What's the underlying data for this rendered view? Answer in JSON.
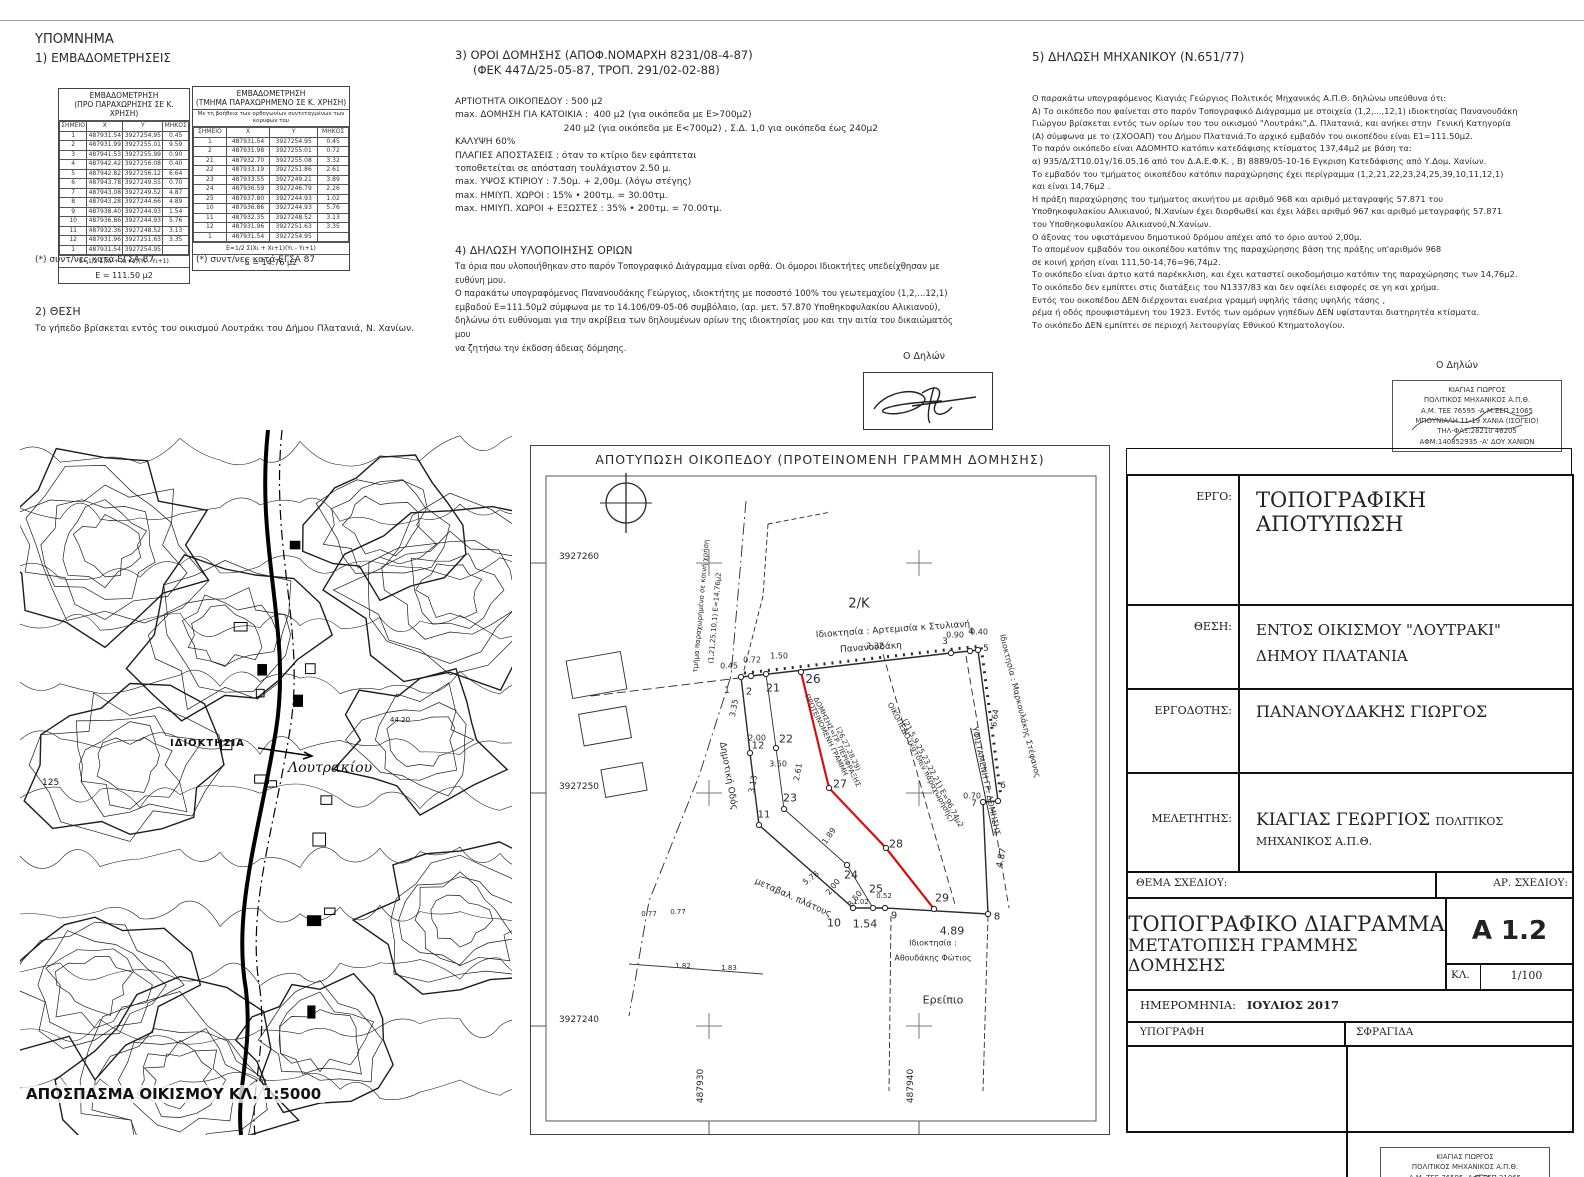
{
  "colors": {
    "line": "#2a2a2a",
    "red_line": "#d40f0f",
    "border": "#111111"
  },
  "legend": {
    "title": "ΥΠΟΜΝΗΜΑ",
    "section1_title": "1) ΕΜΒΑΔΟΜΕΤΡΗΣΕΙΣ",
    "table1": {
      "title_l1": "ΕΜΒΑΔΟΜΕΤΡΗΣΗ",
      "title_l2": "(ΠΡΟ ΠΑΡΑΧΩΡΗΣΗΣ ΣΕ Κ. ΧΡΗΣΗ)",
      "headers": [
        "ΣΗΜΕΙΟ",
        "Χ",
        "Υ",
        "ΜΗΚΟΣ"
      ],
      "rows": [
        [
          "1",
          "487931.54",
          "3927254.95",
          "0.45"
        ],
        [
          "2",
          "487931.99",
          "3927255.01",
          "9.59"
        ],
        [
          "3",
          "487941.53",
          "3927255.99",
          "0.90"
        ],
        [
          "4",
          "487942.42",
          "3927256.08",
          "0.40"
        ],
        [
          "5",
          "487942.82",
          "3927256.12",
          "6.64"
        ],
        [
          "6",
          "487943.78",
          "3927249.55",
          "0.70"
        ],
        [
          "7",
          "487943.08",
          "3927249.52",
          "4.87"
        ],
        [
          "8",
          "487943.28",
          "3927244.66",
          "4.89"
        ],
        [
          "9",
          "487938.40",
          "3927244.93",
          "1.54"
        ],
        [
          "10",
          "487936.86",
          "3927244.93",
          "5.76"
        ],
        [
          "11",
          "487932.36",
          "3927248.52",
          "3.13"
        ],
        [
          "12",
          "487931.96",
          "3927251.63",
          "3.35"
        ],
        [
          "1",
          "487931.54",
          "3927254.95",
          ""
        ]
      ],
      "formula": "Ε=1/2 Σ(Χι + Χι+1)(Υι - Υι+1)",
      "area": "Ε = 111.50 μ2",
      "footnote": "(*) συντ/νες κατά ΕΓΣΑ 87"
    },
    "table2": {
      "title_l1": "ΕΜΒΑΔΟΜΕΤΡΗΣΗ",
      "title_l2": "(ΤΜΗΜΑ ΠΑΡΑΧΩΡΗΜΕΝΟ ΣΕ Κ. ΧΡΗΣΗ)",
      "subtitle": "Με τη βοήθεια των ορθογωνίων συντεταγμένων των κορυφών του",
      "headers": [
        "ΣΗΜΕΙΟ",
        "Χ",
        "Υ",
        "ΜΗΚΟΣ"
      ],
      "rows": [
        [
          "1",
          "487931.54",
          "3927254.95",
          "0.45"
        ],
        [
          "2",
          "487931.98",
          "3927255.01",
          "0.72"
        ],
        [
          "21",
          "487932.70",
          "3927255.08",
          "3.32"
        ],
        [
          "22",
          "487933.19",
          "3927251.86",
          "2.61"
        ],
        [
          "23",
          "487933.55",
          "3927249.21",
          "3.89"
        ],
        [
          "24",
          "487936.59",
          "3927246.79",
          "2.26"
        ],
        [
          "25",
          "487937.80",
          "3927244.93",
          "1.02"
        ],
        [
          "10",
          "487936.86",
          "3927244.93",
          "5.76"
        ],
        [
          "11",
          "487932.35",
          "3927248.52",
          "3.13"
        ],
        [
          "12",
          "487931.96",
          "3927251.63",
          "3.35"
        ],
        [
          "1",
          "487931.54",
          "3927254.95",
          ""
        ]
      ],
      "formula": "Ε=1/2 Σ(Χι + Χι+1)(Υι - Υι+1)",
      "area": "Ε = 14.76 μ2",
      "footnote": "(*) συντ/νες κατά ΕΓΣΑ 87"
    },
    "section2_title": "2) ΘΕΣΗ",
    "section2_text": "Το γήπεδο βρίσκεται εντός του οικισμού Λουτράκι του Δήμου Πλατανιά, Ν. Χανίων."
  },
  "terms": {
    "title_l1": "3) ΟΡΟΙ ΔΟΜΗΣΗΣ (ΑΠΟΦ.ΝΟΜΑΡΧΗ 8231/08-4-87)",
    "title_l2": "(ΦΕΚ 447Δ/25-05-87, ΤΡΟΠ. 291/02-02-88)",
    "lines": [
      "ΑΡΤΙΟΤΗΤΑ ΟΙΚΟΠΕΔΟΥ : 500 μ2",
      "max. ΔΟΜΗΣΗ ΓΙΑ ΚΑΤΟΙΚΙΑ :  400 μ2 (για οικόπεδα με Ε>700μ2)",
      "                                      240 μ2 (για οικόπεδα με Ε<700μ2) , Σ.Δ. 1,0 για οικόπεδα έως 240μ2",
      "ΚΑΛΥΨΗ 60%",
      "ΠΛΑΓΙΕΣ ΑΠΟΣΤΑΣΕΙΣ : όταν το κτίριο δεν εφάπτεται",
      "τοποθετείται σε απόσταση τουλάχιστον 2.50 μ.",
      "max. ΥΨΟΣ ΚΤΙΡΙΟΥ : 7.50μ. + 2,00μ. (λόγω στέγης)",
      "max. ΗΜΙΥΠ. ΧΩΡΟΙ : 15% • 200τμ. = 30.00τμ.",
      "max. ΗΜΙΥΠ. ΧΩΡΟΙ + ΕΞΩΣΤΕΣ : 35% • 200τμ. = 70.00τμ."
    ]
  },
  "declaration_limits": {
    "title": "4) ΔΗΛΩΣΗ ΥΛΟΠΟΙΗΣΗΣ ΟΡΙΩΝ",
    "lines": [
      "Τα όρια που υλοποιήθηκαν στο παρόν Τοπογραφικό Διάγραμμα είναι ορθά. Οι όμοροι Ιδιοκτήτες υπεδείχθησαν με ευθύνη μου.",
      "Ο παρακάτω υπογραφόμενος Πανανουδάκης Γεώργιος, ιδιοκτήτης με ποσοστό 100% του γεωτεμαχίου (1,2,...12,1)",
      "εμβαδού Ε=111.50μ2 σύμφωνα με το 14.106/09-05-06 συμβόλαιο, (αρ. μετ. 57.870 Υποθηκοφυλακίου Αλικιανού),",
      "δηλώνω ότι ευθύνομαι για την ακρίβεια των δηλουμένων ορίων της ιδιοκτησίας μου και την αιτία του δικαιώματός μου",
      "να ζητήσω την έκδοση άδειας δόμησης."
    ]
  },
  "declaration_engineer": {
    "title": "5) ΔΗΛΩΣΗ ΜΗΧΑΝΙΚΟΥ (Ν.651/77)",
    "lines": [
      "Ο παρακάτω υπογραφόμενος Κιαγιάς Γεώργιος Πολιτικός Μηχανικός Α.Π.Θ. δηλώνω υπεύθυνα ότι:",
      "Α) Το οικόπεδο που φαίνεται στο παρόν Τοπογραφικό Διάγραμμα με στοιχεία (1,2,...,12,1) ιδιοκτησίας Πανανουδάκη",
      "Γιώργου βρίσκεται εντός των ορίων του του οικισμού \"Λουτράκι\",Δ. Πλατανιά, και ανήκει στην  Γενική Κατηγορία",
      "(Α) σύμφωνα με το (ΣΧΟΟΑΠ) του Δήμου Πλατανιά.Το αρχικό εμβαδόν του οικοπέδου είναι Ε1=111.50μ2.",
      "Το παρόν οικόπεδο είναι ΑΔΟΜΗΤΟ κατόπιν κατεδάφισης κτίσματος 137,44μ2 με βάση τα:",
      "α) 935/Δ/ΣΤ10.01γ/16.05.16 από τον Δ.Α.Ε.Φ.Κ. , Β) 8889/05-10-16 Εγκριση Κατεδάφισης από Υ.Δομ. Χανίων.",
      "Το εμβαδόν του τμήματος οικοπέδου κατόπιν παραχώρησης έχει περίγραμμα (1,2,21,22,23,24,25,39,10,11,12,1)",
      "και είναι 14,76μ2 .",
      "Η πράξη παραχώρησης του τμήματος ακινήτου με αριθμό 968 και αριθμό μεταγραφής 57.871 του",
      "Υποθηκοφυλακίου Αλικιανού, Ν.Χανίων έχει διορθωθεί και έχει λάβει αριθμό 967 και αριθμό μεταγραφής 57.871",
      "του Υποθηκοφυλακίου Αλικιανού,Ν.Χανίων.",
      "Ο άξονας του υφιστάμενου δημοτικού δρόμου απέχει από το όριο αυτού 2,00μ.",
      "Το απομένον εμβαδόν του οικοπέδου κατόπιν της παραχώρησης βάση της πράξης υπ'αριθμόν 968",
      "σε κοινή χρήση είναι 111,50-14,76=96,74μ2.",
      "Το οικόπεδο είναι άρτιο κατά παρέκκλιση, και έχει καταστεί οικοδομήσιμο κατόπιν της παραχώρησης των 14,76μ2.",
      "Το οικόπεδο δεν εμπίπτει στις διατάξεις του Ν1337/83 και δεν οφείλει εισφορές σε γη και χρήμα.",
      "Εντός του οικοπέδου ΔΕΝ διέρχονται εναέρια γραμμή υψηλής τάσης υψηλής τάσης ,",
      "ρέμα ή οδός προυφιστάμενη του 1923. Εντός των ομόρων γηπέδων ΔΕΝ υφίστανται διατηρητέα κτίσματα.",
      "Το οικόπεδο ΔΕΝ εμπίπτει σε περιοχή λειτουργίας Εθνικού Κτηματολογίου."
    ]
  },
  "signer_label": "Ο Δηλών",
  "stamp": {
    "lines": [
      "ΚΙΑΓΙΑΣ ΓΙΩΡΓΟΣ",
      "ΠΟΛΙΤΙΚΟΣ ΜΗΧΑΝΙΚΟΣ Α.Π.Θ.",
      "Α.Μ. ΤΕΕ 76595 -Α.Μ.ΕΕΠ 21065",
      "ΜΠΟΥΝΙΑΛΗ 11-19 ΧΑΝΙΑ (ΙΣΟΓΕΙΟ)",
      "ΤΗΛ-ΦΑΞ:28210 46205",
      "ΑΦΜ:140852935 -Α' ΔΟΥ ΧΑΝΙΩΝ"
    ]
  },
  "map": {
    "caption": "ΑΠΟΣΠΑΣΜΑ ΟΙΚΙΣΜΟΥ ΚΛ. 1:5000",
    "label_property": "ΙΔΙΟΚΤΗΣΙΑ",
    "label_place": "Λουτρακίου",
    "elev1": "44.20",
    "elev2": "125"
  },
  "plan": {
    "title": "ΑΠΟΤΥΠΩΣΗ ΟΙΚΟΠΕΔΟΥ (ΠΡΟΤΕΙΝΟΜΕΝΗ ΓΡΑΜΜΗ ΔΟΜΗΣΗΣ)",
    "geo": {
      "frame": [
        15,
        30,
        550,
        645
      ],
      "outline": [
        [
          210,
          231
        ],
        [
          220,
          230
        ],
        [
          420,
          207
        ],
        [
          439,
          205
        ],
        [
          447,
          204
        ],
        [
          467,
          355
        ],
        [
          452,
          356
        ],
        [
          457,
          468
        ],
        [
          354,
          462
        ],
        [
          322,
          462
        ],
        [
          228,
          379
        ],
        [
          219,
          307
        ],
        [
          210,
          231
        ]
      ],
      "ceded": [
        [
          235,
          228
        ],
        [
          245,
          302
        ],
        [
          253,
          363
        ],
        [
          316,
          419
        ],
        [
          342,
          462
        ]
      ],
      "red": [
        [
          270,
          226
        ],
        [
          298,
          342
        ],
        [
          355,
          402
        ],
        [
          403,
          463
        ]
      ],
      "dashes": [
        {
          "pts": [
            [
              435,
              210
            ],
            [
              478,
              462
            ]
          ],
          "d": "7,4"
        },
        {
          "pts": [
            [
              352,
              208
            ],
            [
              425,
              462
            ]
          ],
          "d": "7,4"
        },
        {
          "pts": [
            [
              215,
              55
            ],
            [
              200,
              230
            ],
            [
              168,
              330
            ],
            [
              118,
              455
            ],
            [
              98,
              570
            ]
          ],
          "d": "12,4,2,4"
        },
        {
          "pts": [
            [
              237,
              78
            ],
            [
              232,
              150
            ],
            [
              212,
              228
            ]
          ],
          "d": "5,3"
        },
        {
          "pts": [
            [
              237,
              78
            ],
            [
              300,
              66
            ]
          ],
          "d": "5,3"
        },
        {
          "pts": [
            [
              360,
              470
            ],
            [
              358,
              645
            ]
          ],
          "d": "6,3"
        },
        {
          "pts": [
            [
              457,
              470
            ],
            [
              452,
              645
            ]
          ],
          "d": "6,3"
        },
        {
          "pts": [
            [
              98,
              518
            ],
            [
              232,
              528
            ]
          ],
          "d": "2,0"
        },
        {
          "pts": [
            [
              60,
              250
            ],
            [
              208,
              232
            ]
          ],
          "d": "9,4"
        }
      ],
      "rects": [
        [
          38,
          210,
          55,
          38
        ],
        [
          50,
          264,
          48,
          32
        ],
        [
          72,
          320,
          42,
          28
        ]
      ],
      "crosses": [
        [
          178,
          117
        ],
        [
          388,
          117
        ],
        [
          178,
          347
        ],
        [
          388,
          347
        ],
        [
          178,
          580
        ],
        [
          388,
          580
        ]
      ],
      "points": [
        [
          210,
          231
        ],
        [
          220,
          230
        ],
        [
          235,
          228
        ],
        [
          270,
          226
        ],
        [
          420,
          207
        ],
        [
          439,
          205
        ],
        [
          447,
          204
        ],
        [
          467,
          355
        ],
        [
          452,
          356
        ],
        [
          457,
          468
        ],
        [
          354,
          462
        ],
        [
          322,
          462
        ],
        [
          228,
          379
        ],
        [
          219,
          307
        ],
        [
          245,
          302
        ],
        [
          253,
          363
        ],
        [
          316,
          419
        ],
        [
          342,
          462
        ],
        [
          298,
          342
        ],
        [
          355,
          402
        ],
        [
          403,
          463
        ]
      ],
      "north": [
        95,
        57
      ],
      "yticks": [
        [
          117,
          "3927260"
        ],
        [
          347,
          "3927250"
        ],
        [
          580,
          "3927240"
        ]
      ],
      "xticks": [
        [
          178,
          "487930"
        ],
        [
          388,
          "487940"
        ]
      ]
    },
    "labels": [
      {
        "t": "1",
        "x": 196,
        "y": 245,
        "s": 9
      },
      {
        "t": "2",
        "x": 218,
        "y": 246,
        "s": 10
      },
      {
        "t": "21",
        "x": 242,
        "y": 242,
        "s": 11
      },
      {
        "t": "26",
        "x": 282,
        "y": 233,
        "s": 12
      },
      {
        "t": "3",
        "x": 414,
        "y": 196,
        "s": 9
      },
      {
        "t": "4",
        "x": 440,
        "y": 186,
        "s": 9
      },
      {
        "t": "5",
        "x": 455,
        "y": 203,
        "s": 9
      },
      {
        "t": "6",
        "x": 472,
        "y": 340,
        "s": 9
      },
      {
        "t": "7",
        "x": 443,
        "y": 358,
        "s": 9
      },
      {
        "t": "8",
        "x": 466,
        "y": 471,
        "s": 10
      },
      {
        "t": "9",
        "x": 363,
        "y": 470,
        "s": 10
      },
      {
        "t": "10",
        "x": 303,
        "y": 477,
        "s": 11
      },
      {
        "t": "1.54",
        "x": 334,
        "y": 478,
        "s": 11
      },
      {
        "t": "11",
        "x": 233,
        "y": 369,
        "s": 10
      },
      {
        "t": "12",
        "x": 227,
        "y": 300,
        "s": 10
      },
      {
        "t": "22",
        "x": 255,
        "y": 293,
        "s": 11
      },
      {
        "t": "23",
        "x": 259,
        "y": 352,
        "s": 11
      },
      {
        "t": "24",
        "x": 320,
        "y": 429,
        "s": 11
      },
      {
        "t": "25",
        "x": 345,
        "y": 443,
        "s": 11
      },
      {
        "t": "27",
        "x": 309,
        "y": 338,
        "s": 11
      },
      {
        "t": "28",
        "x": 365,
        "y": 398,
        "s": 11
      },
      {
        "t": "29",
        "x": 411,
        "y": 452,
        "s": 11
      },
      {
        "t": "0.45",
        "x": 198,
        "y": 220,
        "s": 8
      },
      {
        "t": "0.72",
        "x": 221,
        "y": 214,
        "s": 8
      },
      {
        "t": "1.50",
        "x": 248,
        "y": 210,
        "s": 8
      },
      {
        "t": "2.32",
        "x": 344,
        "y": 200,
        "s": 8
      },
      {
        "t": "0.90",
        "x": 424,
        "y": 189,
        "s": 8
      },
      {
        "t": "0.40",
        "x": 448,
        "y": 186,
        "s": 8
      },
      {
        "t": "6.64",
        "x": 464,
        "y": 272,
        "s": 8,
        "r": -82
      },
      {
        "t": "0.70",
        "x": 441,
        "y": 350,
        "s": 8
      },
      {
        "t": "4.87",
        "x": 471,
        "y": 412,
        "s": 9,
        "r": -78
      },
      {
        "t": "4.89",
        "x": 421,
        "y": 485,
        "s": 11
      },
      {
        "t": "1.02",
        "x": 330,
        "y": 456,
        "s": 7
      },
      {
        "t": "0.52",
        "x": 353,
        "y": 450,
        "s": 7
      },
      {
        "t": "3.35",
        "x": 203,
        "y": 262,
        "s": 8,
        "r": -80
      },
      {
        "t": "3.13",
        "x": 222,
        "y": 338,
        "s": 8,
        "r": -80
      },
      {
        "t": "2.00",
        "x": 226,
        "y": 292,
        "s": 8
      },
      {
        "t": "3.50",
        "x": 247,
        "y": 318,
        "s": 8
      },
      {
        "t": "2.61",
        "x": 267,
        "y": 326,
        "s": 8,
        "r": -80
      },
      {
        "t": "1.89",
        "x": 298,
        "y": 390,
        "s": 8,
        "r": -55
      },
      {
        "t": "5.76",
        "x": 280,
        "y": 432,
        "s": 8,
        "r": -36
      },
      {
        "t": "2.00",
        "x": 302,
        "y": 441,
        "s": 8,
        "r": -52
      },
      {
        "t": "3.50",
        "x": 324,
        "y": 453,
        "s": 8,
        "r": -52
      },
      {
        "t": "1.82",
        "x": 152,
        "y": 520,
        "s": 7
      },
      {
        "t": "1.83",
        "x": 198,
        "y": 522,
        "s": 7
      },
      {
        "t": "0.77",
        "x": 118,
        "y": 468,
        "s": 7
      },
      {
        "t": "0.77",
        "x": 147,
        "y": 466,
        "s": 7
      },
      {
        "t": "2/Κ",
        "x": 328,
        "y": 158,
        "s": 13
      },
      {
        "t": "Ιδιοκτησία : Αρτεμισία κ Στυλιανή",
        "x": 362,
        "y": 184,
        "s": 9,
        "r": -4
      },
      {
        "t": "Πανανουδάκη",
        "x": 340,
        "y": 202,
        "s": 9,
        "r": -4
      },
      {
        "t": "Ιδιοκτησία : Μαρκουλάκης Στέφανος",
        "x": 489,
        "y": 260,
        "s": 8,
        "r": 76
      },
      {
        "t": "ΥΦΙΣΤΑΜΕΝΗ ΓΡ. ΔΟΜΗΣΗΣ",
        "x": 455,
        "y": 335,
        "s": 8,
        "r": 78,
        "u": 1
      },
      {
        "t": "ΟΙΚΟΠΕΔΟ (κατόπιν παραχώρησης)",
        "x": 390,
        "y": 316,
        "s": 7.5,
        "r": 62
      },
      {
        "t": "(21,5,9,25,23,22,21) Ε=96,74μ2",
        "x": 402,
        "y": 327,
        "s": 7.5,
        "r": 62
      },
      {
        "t": "ΠΡΟΤΕΙΝΟΜΕΝΗ ΓΡΑΜΜΗ",
        "x": 295,
        "y": 289,
        "s": 7,
        "r": 64
      },
      {
        "t": "ΔΟΜΗΣΗΣ=ΓΡ. ΠΕΡΙΦΡΑΞΗΣ",
        "x": 306,
        "y": 296,
        "s": 7,
        "r": 64
      },
      {
        "t": "(26,27,28,29)",
        "x": 317,
        "y": 303,
        "s": 7,
        "r": 64
      },
      {
        "t": "τμήμα παραχωρημένο σε κοινή χρήση",
        "x": 170,
        "y": 160,
        "s": 7,
        "r": -85
      },
      {
        "t": "(1,21,25,10,1) Ε=14,76μ2",
        "x": 184,
        "y": 172,
        "s": 7,
        "r": -85
      },
      {
        "t": "Δημοτική Οδός",
        "x": 197,
        "y": 330,
        "s": 9,
        "r": 80
      },
      {
        "t": "μεταβαλ. πλάτους",
        "x": 262,
        "y": 452,
        "s": 9,
        "r": 24
      },
      {
        "t": "Ιδιοκτησία :",
        "x": 402,
        "y": 497,
        "s": 8
      },
      {
        "t": "Αθουδάκης Φώτιος",
        "x": 402,
        "y": 512,
        "s": 8
      },
      {
        "t": "Ερείπιο",
        "x": 412,
        "y": 554,
        "s": 11
      }
    ]
  },
  "titleblock": {
    "rows": [
      {
        "label": "ΕΡΓΟ:",
        "value": "ΤΟΠΟΓΡΑΦΙΚΗ ΑΠΟΤΥΠΩΣΗ",
        "value2": ""
      },
      {
        "label": "ΘΕΣΗ:",
        "value": "ΕΝΤΟΣ ΟΙΚΙΣΜΟΥ \"ΛΟΥΤΡΑΚΙ\"",
        "value2": "ΔΗΜΟΥ ΠΛΑΤΑΝΙΑ"
      },
      {
        "label": "ΕΡΓΟΔΟΤΗΣ:",
        "value": "ΠΑΝΑΝΟΥΔΑΚΗΣ ΓΙΩΡΓΟΣ",
        "value2": ""
      },
      {
        "label": "ΜΕΛΕΤΗΤΗΣ:",
        "value": "ΚΙΑΓΙΑΣ ΓΕΩΡΓΙΟΣ",
        "value2": "ΠΟΛΙΤΙΚΟΣ ΜΗΧΑΝΙΚΟΣ Α.Π.Θ."
      }
    ],
    "thema_label": "ΘΕΜΑ ΣΧΕΔΙΟΥ:",
    "ar_label": "ΑΡ. ΣΧΕΔΙΟΥ:",
    "title1": "ΤΟΠΟΓΡΑΦΙΚΟ ΔΙΑΓΡΑΜΜΑ",
    "title2": "ΜΕΤΑΤΟΠΙΣΗ ΓΡΑΜΜΗΣ ΔΟΜΗΣΗΣ",
    "number": "Α 1.2",
    "kl_label": "ΚΛ.",
    "scale": "1/100",
    "date_label": "ΗΜΕΡΟΜΗΝΙΑ:",
    "date": "ΙΟΥΛΙΟΣ 2017",
    "sig_label": "ΥΠΟΓΡΑΦΗ",
    "stamp_label": "ΣΦΡΑΓΙΔΑ"
  }
}
